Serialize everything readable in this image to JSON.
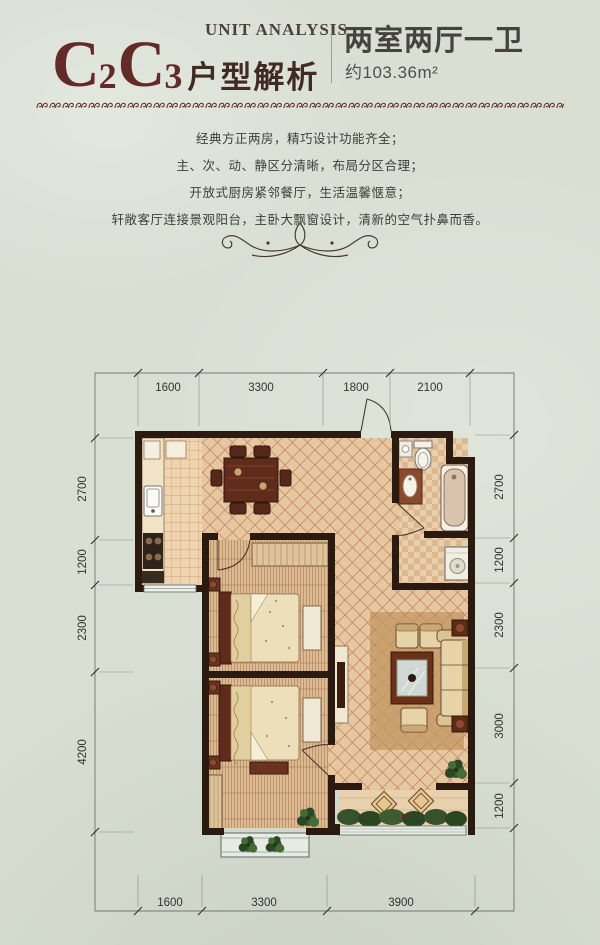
{
  "header": {
    "unit_analysis": "UNIT ANALYSIS",
    "series": {
      "c1": "C",
      "s1": "2",
      "c2": "C",
      "s2": "3"
    },
    "title_cn": "户型解析",
    "unit_type": "两室两厅一卫",
    "area": "约103.36m²"
  },
  "description": {
    "lines": [
      "经典方正两房，精巧设计功能齐全；",
      "主、次、动、静区分清晰，布局分区合理；",
      "开放式厨房紧邻餐厅，生活温馨惬意；",
      "轩敞客厅连接景观阳台，主卧大飘窗设计，清新的空气扑鼻而香。"
    ]
  },
  "floorplan": {
    "dims": {
      "top": [
        "1600",
        "3300",
        "1800",
        "2100"
      ],
      "left": [
        "2700",
        "1200",
        "2300",
        "4200"
      ],
      "right": [
        "2700",
        "1200",
        "2300",
        "3000",
        "1200"
      ],
      "bottom": [
        "1600",
        "3300",
        "3900"
      ]
    }
  },
  "colors": {
    "accent_maroon": "#632b28",
    "text_dark": "#3e3d38",
    "wall": "#2a1a10",
    "floor_tan": "#e6c7a0",
    "tile_line": "#b56c4c",
    "paper": "#d9dfd3"
  }
}
